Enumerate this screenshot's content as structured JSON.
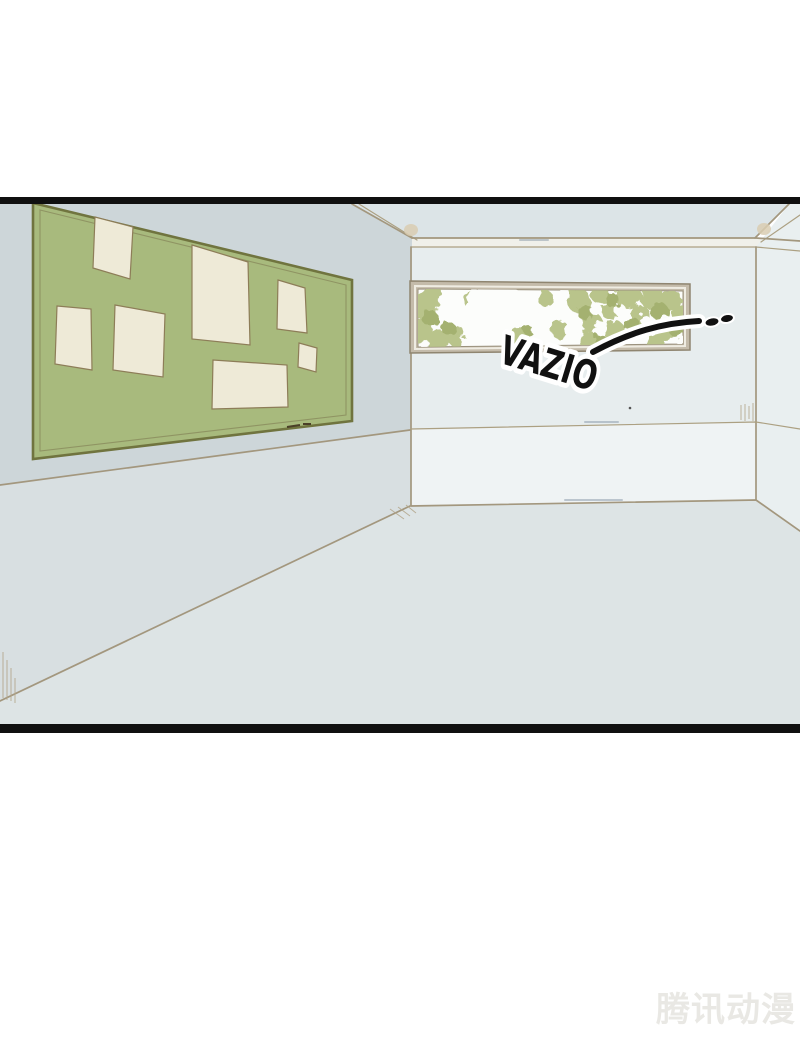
{
  "panel": {
    "description": "empty classroom comic panel",
    "sfx": {
      "text": "VAZIO"
    },
    "watermark": {
      "text": "腾讯动漫"
    }
  },
  "colors": {
    "page_bg": "#ffffff",
    "panel_border": "#101010",
    "left_wall": "#cdd6d9",
    "ceiling": "#dce4e7",
    "molding_band": "#f0f0ea",
    "back_wall_upper": "#e7edee",
    "back_wall_lower": "#eff3f4",
    "right_wall": "#e9eff0",
    "floor": "#dde4e5",
    "board_green": "#a8ba7d",
    "board_frame": "#70743f",
    "board_inner_line": "#8f9463",
    "paper_cream": "#eeead7",
    "window_frame": "#c4bbaa",
    "window_frame_line": "#8f8570",
    "glass_white": "#fcfdfb",
    "foliage_light": "#b9c48b",
    "foliage_dark": "#a4b170",
    "sfx_fill": "#111111",
    "sfx_outline": "#ffffff",
    "watermark_color": "#e9e8e4"
  }
}
